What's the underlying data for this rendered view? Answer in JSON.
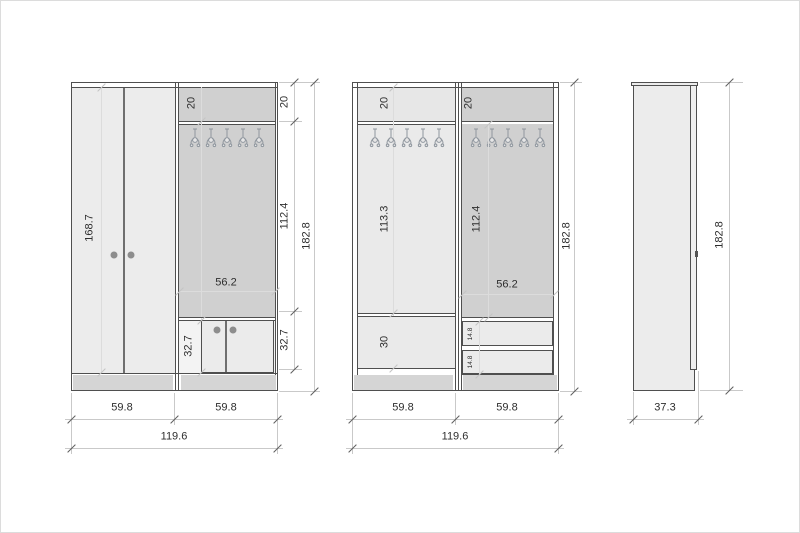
{
  "drawing": {
    "hooks_per_section": 5,
    "views": {
      "front_closed": {
        "door_height": "168.7",
        "top_shelf_height": "20",
        "interior_width": "56.2",
        "shoe_cabinet_height": "32.7",
        "dim_top": "20",
        "dim_middle": "112.4",
        "dim_bottom": "32.7",
        "dim_total_height": "182.8",
        "dim_width_left": "59.8",
        "dim_width_right": "59.8",
        "dim_total_width": "119.6"
      },
      "front_open": {
        "left_top_shelf": "20",
        "right_top_shelf": "20",
        "left_interior_height": "113.3",
        "right_interior_height": "112.4",
        "interior_width": "56.2",
        "left_bottom_compartment": "30",
        "drawer_1": "14.8",
        "drawer_2": "14.8",
        "dim_total_height": "182.8",
        "dim_width_left": "59.8",
        "dim_width_right": "59.8",
        "dim_total_width": "119.6"
      },
      "side": {
        "dim_total_height": "182.8",
        "dim_depth": "37.3"
      }
    },
    "colors": {
      "outline": "#4f4f4f",
      "panel_light": "#ececec",
      "panel_back": "#d0d0d0",
      "plinth": "#d5d5d5",
      "dim_line": "#c9c9c9",
      "tick": "#5f5f5f",
      "text": "#2e2e2e",
      "handle": "#8d8d8d",
      "hook": "#8f969e"
    }
  }
}
